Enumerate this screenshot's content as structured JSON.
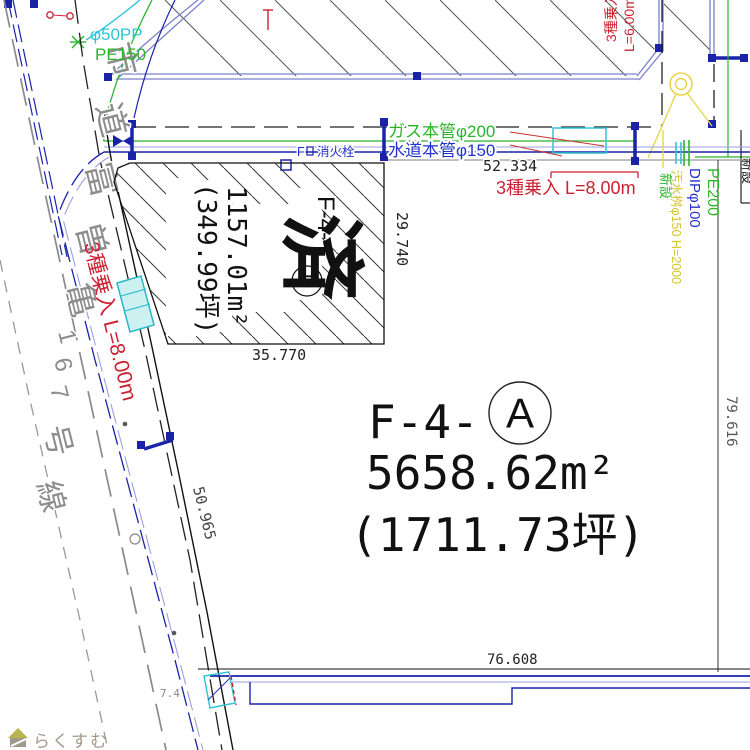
{
  "watermark": {
    "brand": "らくすむ"
  },
  "road": {
    "name": "市道富曽亀167号線",
    "dim_along": "50.965",
    "dim_width": "7.4"
  },
  "strip": {
    "service1": "φ50PP",
    "service2": "PE150",
    "gas_label": "ガス本管φ200",
    "water_label": "水道本管φ150",
    "dim": "52.334",
    "hydrant_f": "F",
    "hydrant": "消火栓"
  },
  "entrances": {
    "west": "3種乗入 L=8.00m",
    "north": "3種乗入 L=8.00m",
    "ne_label": "3種乗入",
    "ne_len": "L=6.00m"
  },
  "parcel_a": {
    "prefix": "F-4-",
    "circle": "A",
    "area": "5658.62m²",
    "tsubo": "(1711.73坪)",
    "dim_bottom": "76.608",
    "dim_east": "79.616"
  },
  "parcel_d": {
    "prefix": "F-4-",
    "circle": "D",
    "area": "1157.01m²",
    "tsubo": "(349.99坪)",
    "stamp": "済",
    "dim_east": "29.740",
    "dim_bottom": "35.770"
  },
  "right_labels": {
    "pe": "PE200",
    "dip": "DIPφ100",
    "sewer": "汚水桝φ150 H=2000",
    "new1": "新設",
    "new2": "新設",
    "new3": "新設"
  },
  "colors": {
    "navy": "#1a23a8",
    "green": "#2ab52a",
    "cyan": "#2cc5d8",
    "red": "#cc2233",
    "yellow": "#e6d44a",
    "purple": "#7b80cc",
    "lavender": "#9aa0dd",
    "gray": "#8a8a8a"
  }
}
